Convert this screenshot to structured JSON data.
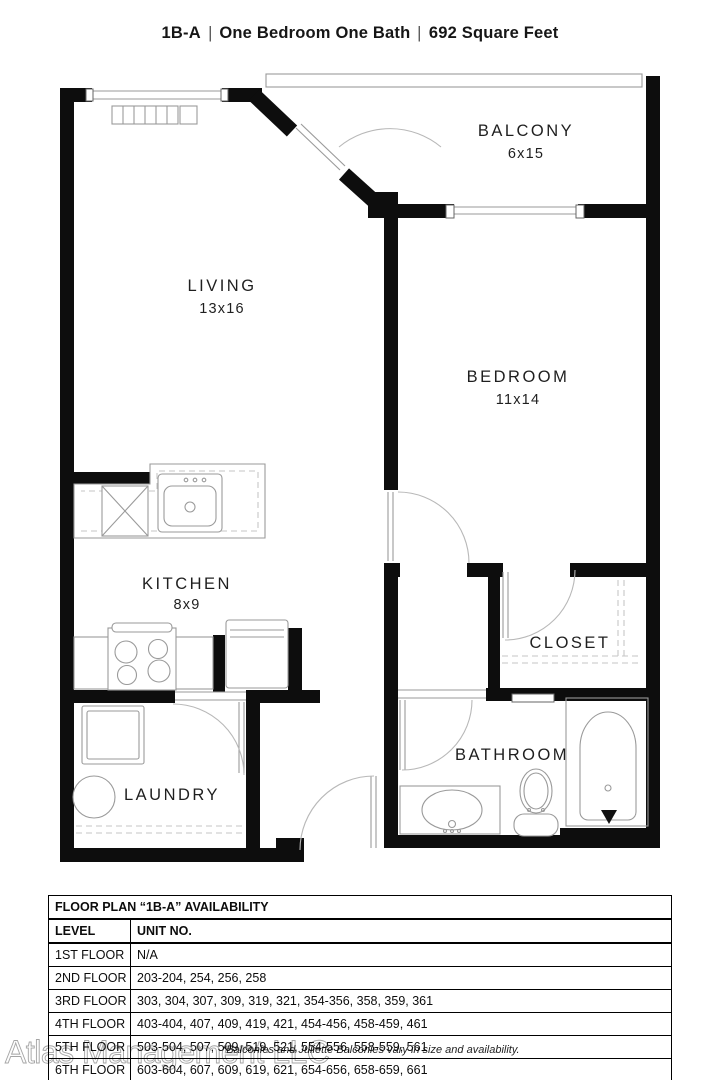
{
  "title": {
    "code": "1B-A",
    "sep": "|",
    "desc": "One Bedroom One Bath",
    "area": "692 Square Feet"
  },
  "plan": {
    "rooms": [
      {
        "id": "living",
        "name": "LIVING",
        "dims": "13x16"
      },
      {
        "id": "balcony",
        "name": "BALCONY",
        "dims": "6x15"
      },
      {
        "id": "bedroom",
        "name": "BEDROOM",
        "dims": "11x14"
      },
      {
        "id": "kitchen",
        "name": "KITCHEN",
        "dims": "8x9"
      },
      {
        "id": "closet",
        "name": "CLOSET",
        "dims": ""
      },
      {
        "id": "bathroom",
        "name": "BATHROOM",
        "dims": ""
      },
      {
        "id": "laundry",
        "name": "LAUNDRY",
        "dims": ""
      }
    ]
  },
  "availability_table": {
    "title": "FLOOR PLAN “1B-A” AVAILABILITY",
    "columns": [
      "LEVEL",
      "UNIT NO."
    ],
    "rows": [
      {
        "level": "1ST FLOOR",
        "units": "N/A"
      },
      {
        "level": "2ND FLOOR",
        "units": "203-204, 254, 256, 258"
      },
      {
        "level": "3RD FLOOR",
        "units": "303, 304, 307, 309, 319, 321, 354-356, 358, 359, 361"
      },
      {
        "level": "4TH FLOOR",
        "units": "403-404, 407, 409, 419, 421, 454-456, 458-459, 461"
      },
      {
        "level": "5TH FLOOR",
        "units": "503-504, 507, 509, 519, 521, 554-556, 558-559, 561"
      },
      {
        "level": "6TH FLOOR",
        "units": "603-604, 607, 609, 619, 621, 654-656, 658-659, 661"
      }
    ]
  },
  "footer": {
    "watermark": "Atlas Management LLC",
    "note": "*Balconies and Juliette Balconies vary in size and availability."
  }
}
